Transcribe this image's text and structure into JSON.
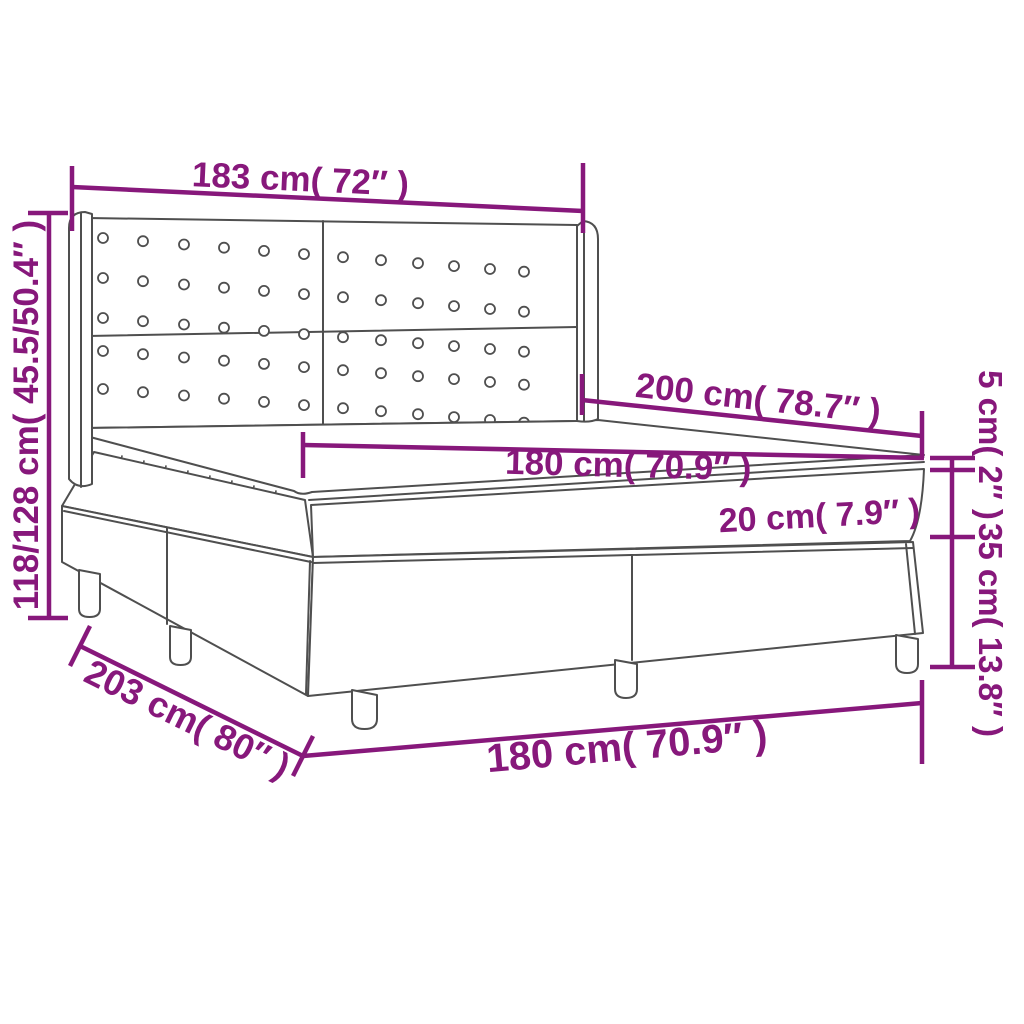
{
  "diagram": {
    "subject": "box spring bed with winged tufted headboard - product dimension diagram",
    "colors": {
      "dimension": "#87187B",
      "outline": "#4F4F4F",
      "background": "#FFFFFF"
    },
    "labels": {
      "headboard_width": "183 cm( 72″ )",
      "bed_height": "118/128 cm( 45.5/50.4″ )",
      "mattress_length": "200 cm( 78.7″ )",
      "mattress_width": "180 cm( 70.9″ )",
      "topper_thickness": "5 cm( 2″ )",
      "mattress_thickness": "20 cm( 7.9″ )",
      "base_height": "35 cm( 13.8″ )",
      "bed_length": "203 cm( 80″ )",
      "base_width": "180 cm( 70.9″ )"
    }
  }
}
